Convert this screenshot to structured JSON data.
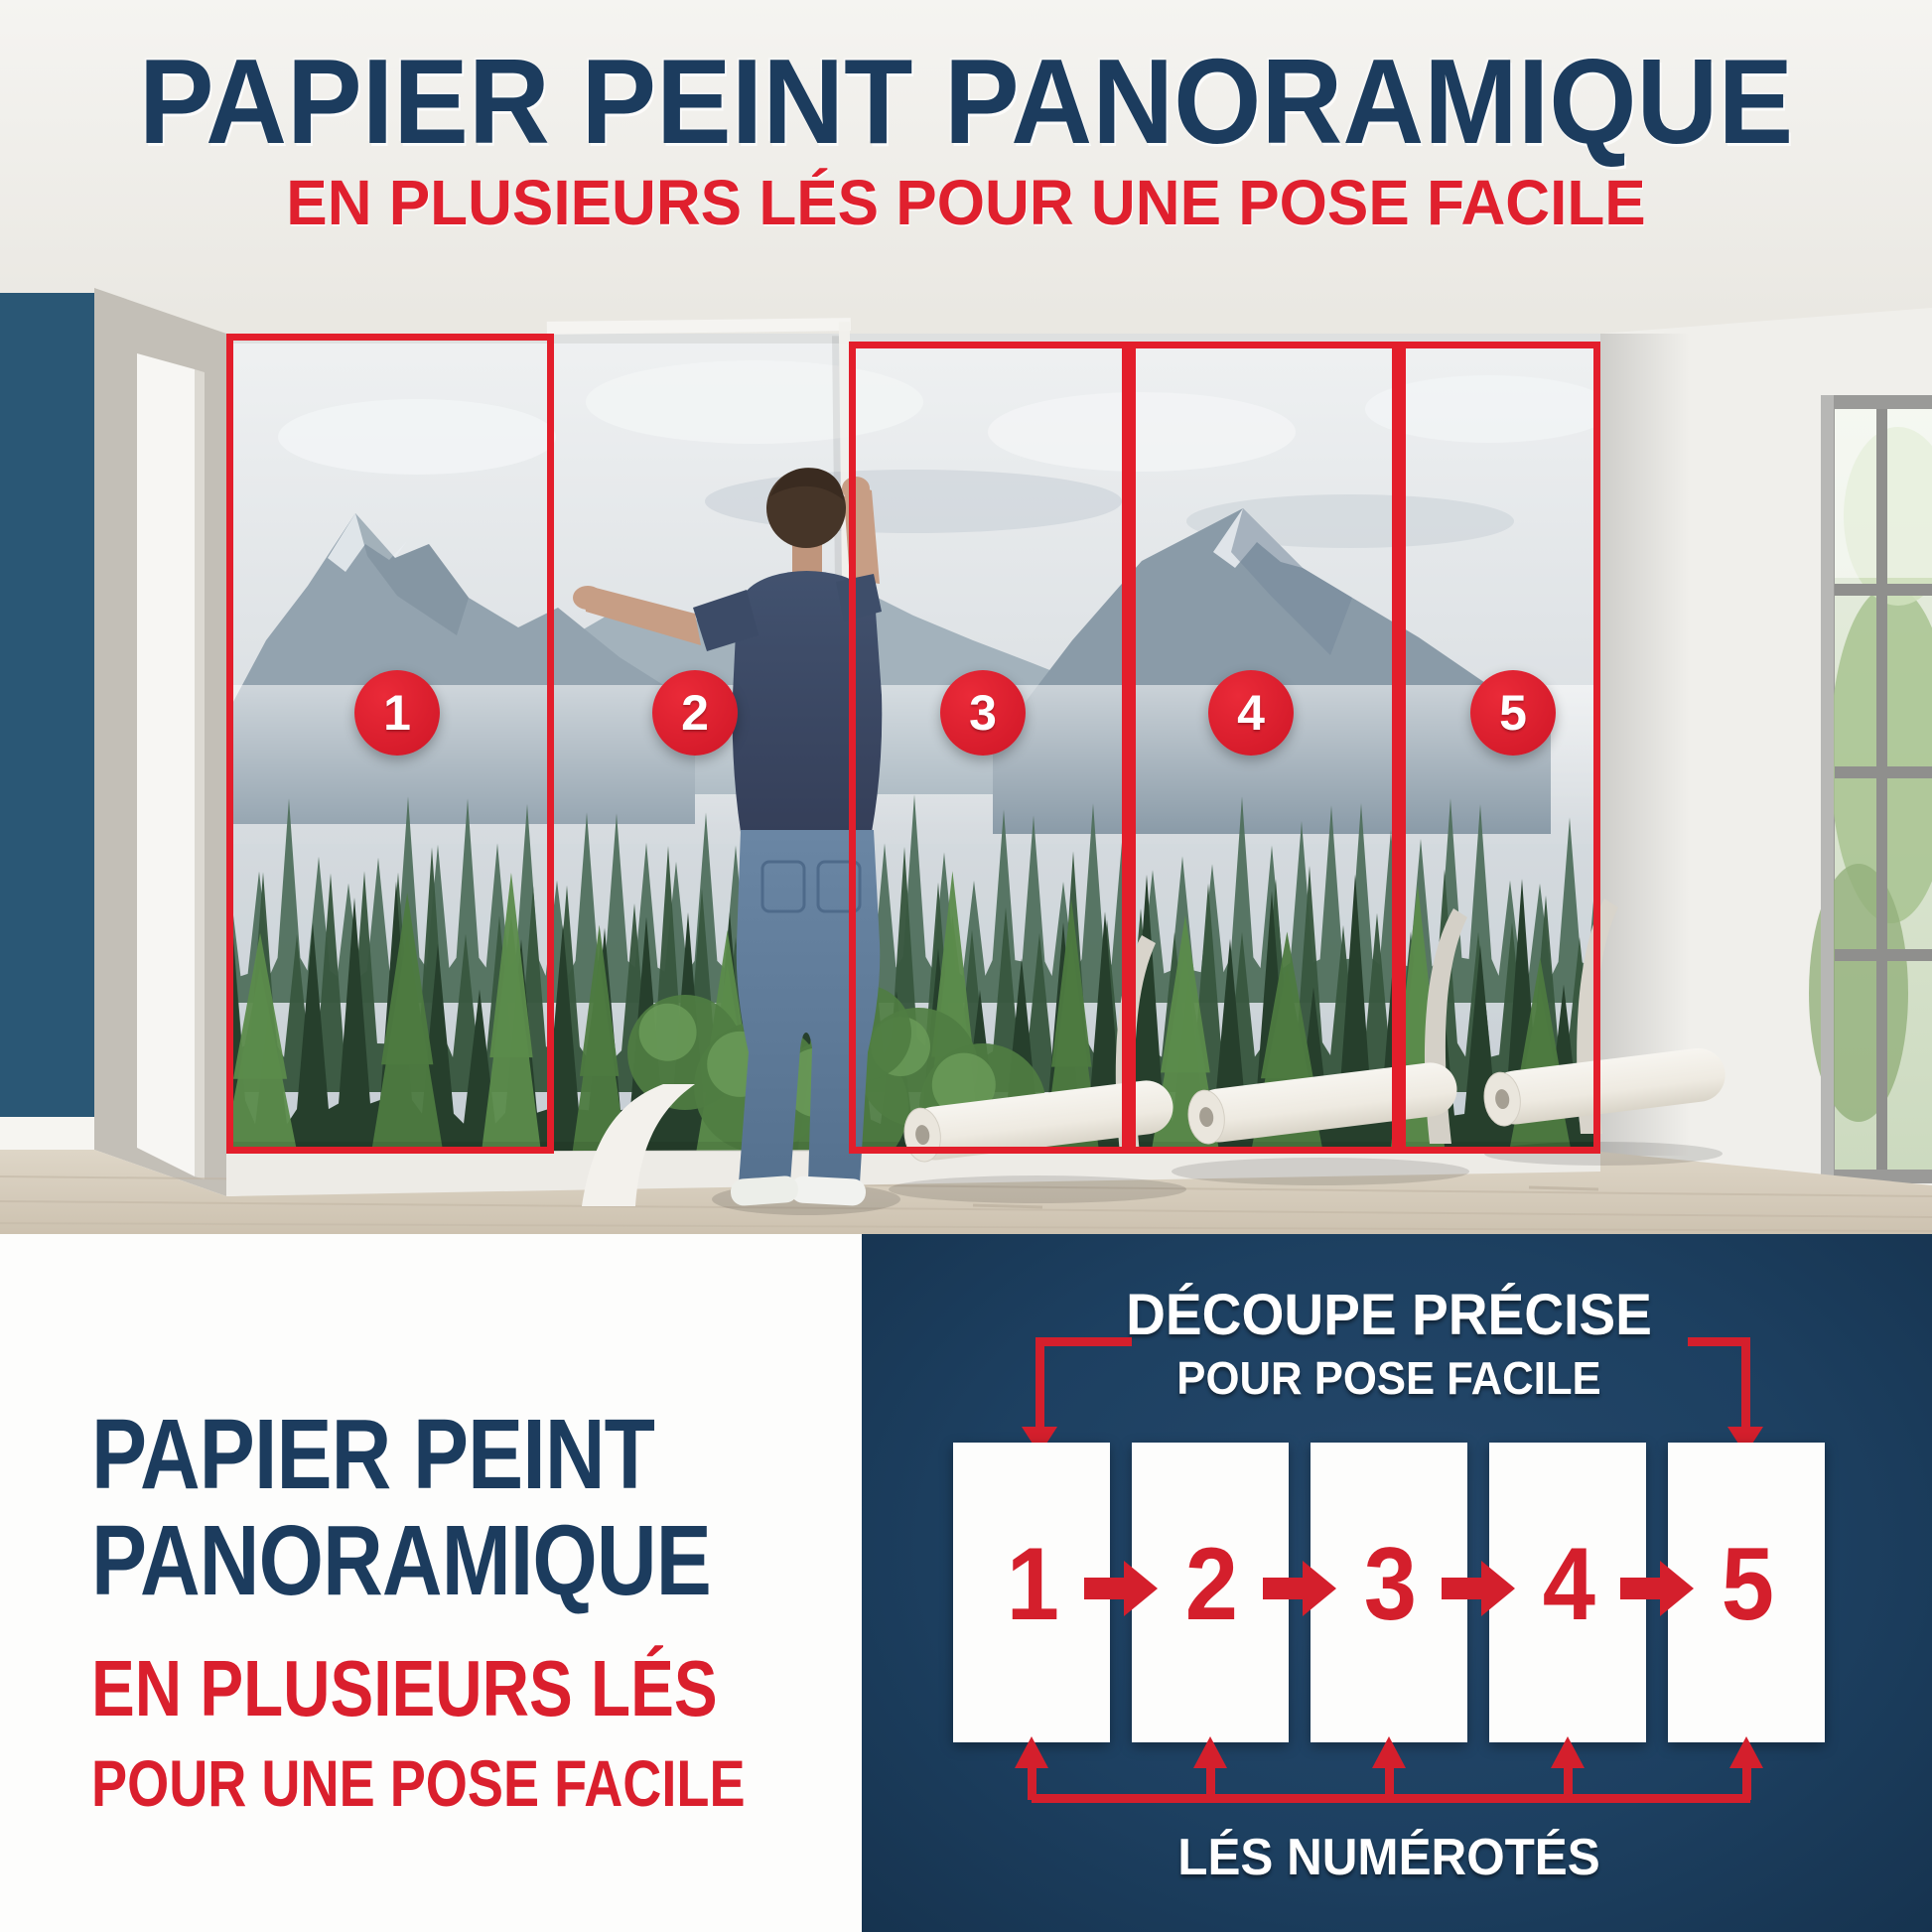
{
  "header": {
    "title": "PAPIER PEINT PANORAMIQUE",
    "subtitle": "EN PLUSIEURS LÉS POUR UNE POSE FACILE"
  },
  "photo": {
    "panels": [
      "1",
      "2",
      "3",
      "4",
      "5"
    ]
  },
  "bottom_left": {
    "title_line1": "PAPIER PEINT",
    "title_line2": "PANORAMIQUE",
    "subtitle_line1": "EN PLUSIEURS LÉS",
    "subtitle_line2": "POUR UNE POSE FACILE"
  },
  "diagram": {
    "title_line1": "DÉCOUPE PRÉCISE",
    "title_line2": "POUR POSE FACILE",
    "strips": [
      "1",
      "2",
      "3",
      "4",
      "5"
    ],
    "caption": "LÉS NUMÉROTÉS"
  },
  "colors": {
    "navy_text": "#1c3c5e",
    "navy_panel": "#1d4061",
    "red": "#da1f2d",
    "accent_wall_blue": "#2a5775"
  }
}
